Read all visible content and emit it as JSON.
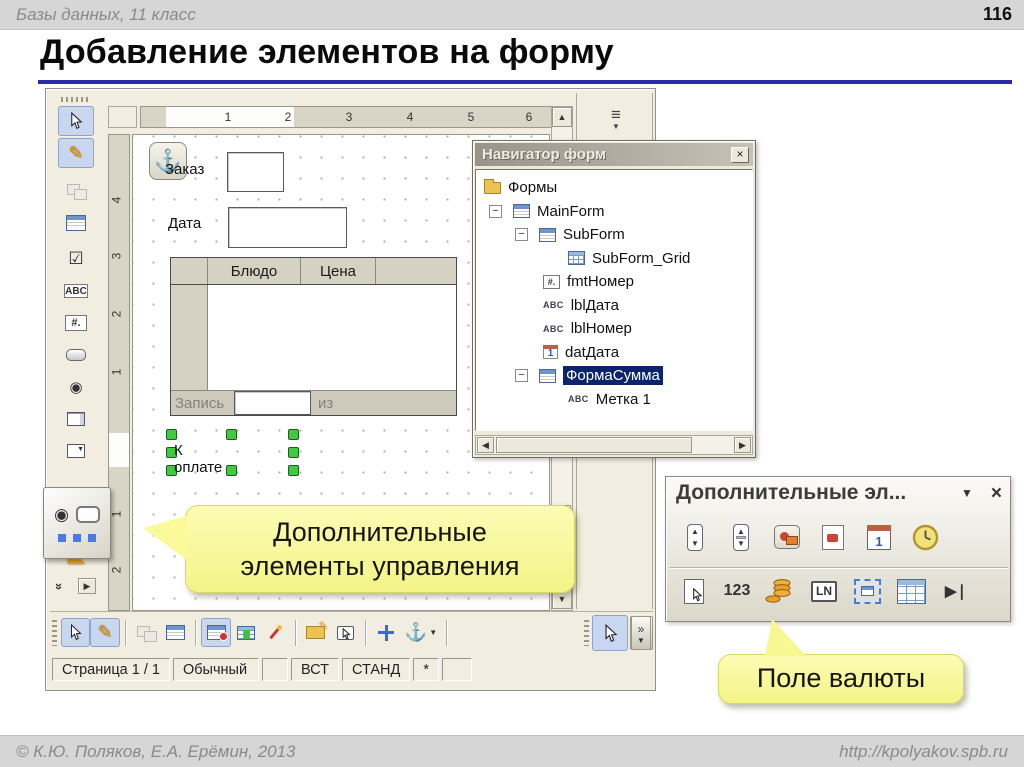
{
  "header": {
    "course_label": "Базы данных, 11 класс",
    "page_number": "116"
  },
  "slide": {
    "title": "Добавление элементов на форму"
  },
  "designer": {
    "hruler_numbers": [
      "1",
      "2",
      "3",
      "4",
      "5",
      "6"
    ],
    "vruler_numbers": [
      "4",
      "3",
      "2",
      "1",
      "1",
      "2"
    ],
    "canvas": {
      "order_label": "Заказ",
      "date_label": "Дата",
      "grid_col_dish": "Блюдо",
      "grid_col_price": "Цена",
      "record_label": "Запись",
      "record_of_label": "из",
      "payment_label": "К оплате"
    },
    "statusbar": {
      "page": "Страница 1 / 1",
      "mode": "Обычный",
      "insert": "ВСТ",
      "selection": "СТАНД",
      "modified": "*"
    }
  },
  "navigator": {
    "title": "Навигатор форм",
    "items": [
      {
        "label": "Формы"
      },
      {
        "label": "MainForm"
      },
      {
        "label": "SubForm"
      },
      {
        "label": "SubForm_Grid"
      },
      {
        "label": "fmtНомер"
      },
      {
        "label": "lblДата"
      },
      {
        "label": "lblНомер"
      },
      {
        "label": "datДата"
      },
      {
        "label": "ФормаСумма",
        "selected": true
      },
      {
        "label": "Метка 1"
      }
    ]
  },
  "more_toolbar": {
    "title": "Дополнительные эл..."
  },
  "icon_glyphs": {
    "abc": "ABC",
    "fmt": "#.",
    "num": "123",
    "pattern": "LN",
    "navbar": "▶❘"
  },
  "callouts": {
    "more_controls_line1": "Дополнительные",
    "more_controls_line2": "элементы управления",
    "currency": "Поле валюты"
  },
  "footer": {
    "copyright": "© К.Ю. Поляков, Е.А. Ерёмин, 2013",
    "url": "http://kpolyakov.spb.ru"
  }
}
